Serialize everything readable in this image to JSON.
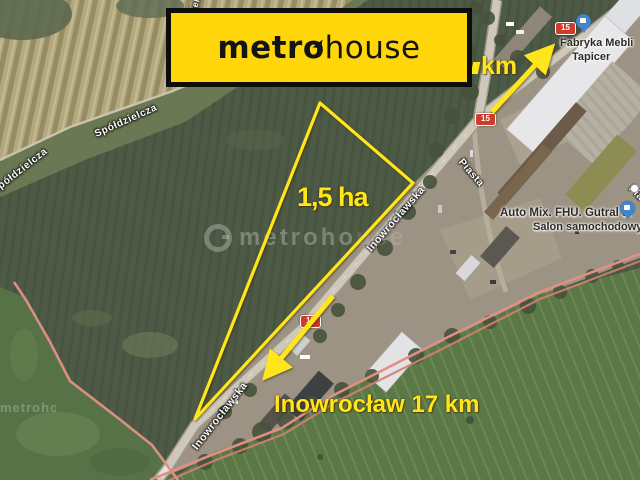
{
  "logo": {
    "part1": "metr",
    "o": "o",
    "part2": "house",
    "bg_color": "#FFD60A",
    "text_color": "#141414"
  },
  "annotations": {
    "area": "1,5 ha",
    "distance_bottom": "Inowrocław 17 km",
    "distance_top_suffix": "km",
    "accent_color": "#FFE61A"
  },
  "watermark": {
    "center_strong": "metroho",
    "center_faint": "use",
    "left_partial": "metroho"
  },
  "roads": {
    "shield_number": "15",
    "shield_color": "#CF3A2A"
  },
  "streets": {
    "spoldzielcza": "Spółdzielcza",
    "inowroclawska": "Inowrocławska",
    "piasta": "Piasta",
    "partial_right": "Pia",
    "partial_top": "dzielcza"
  },
  "pois": {
    "furniture": {
      "line1": "Fabryka Mebli",
      "line2": "Tapicer",
      "marker_color": "#4285C8"
    },
    "car_dealer": {
      "line1": "Auto Mix. FHU. Gutral J.",
      "line2": "Salon samochodowy",
      "marker_color": "#4285C8"
    }
  },
  "map_colors": {
    "railway": "#DF9181",
    "road": "#CFC8BA",
    "field_dark": "#4B5844",
    "field_light_striped": "#B3A87F",
    "field_bright_green": "#5D7847"
  }
}
